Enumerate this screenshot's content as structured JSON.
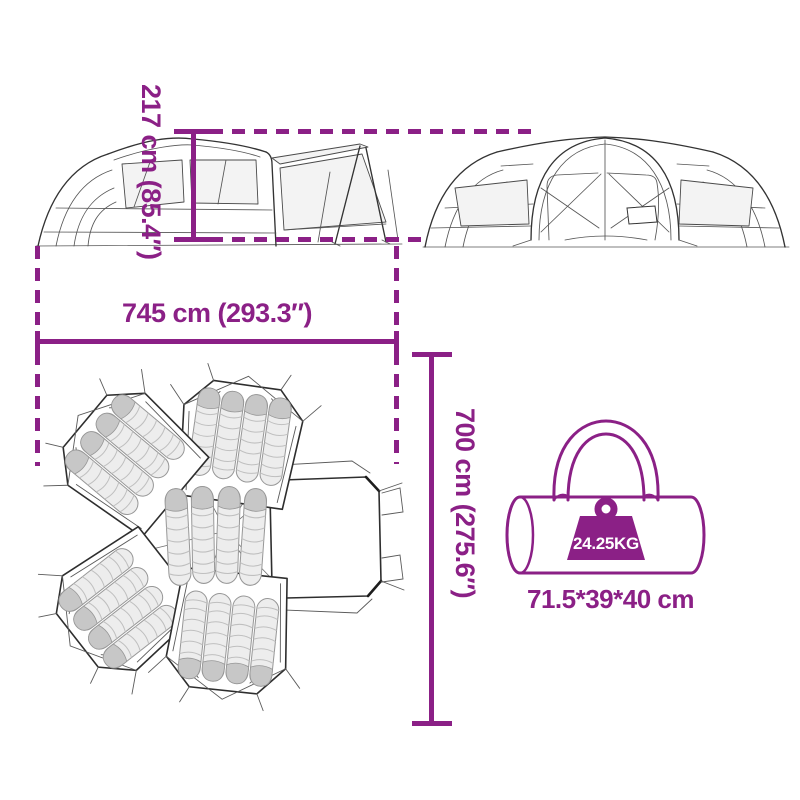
{
  "colors": {
    "accent": "#8B2086",
    "line_art": "#333333",
    "mat_fill": "#ededed",
    "mat_shade": "#c7c7c7"
  },
  "dimensions": {
    "height_label": "217 cm (85.4″)",
    "width_label": "745 cm (293.3″)",
    "depth_label": "700 cm (275.6″)"
  },
  "bag": {
    "weight_label": "24.25KG",
    "size_label": "71.5*39*40 cm"
  }
}
